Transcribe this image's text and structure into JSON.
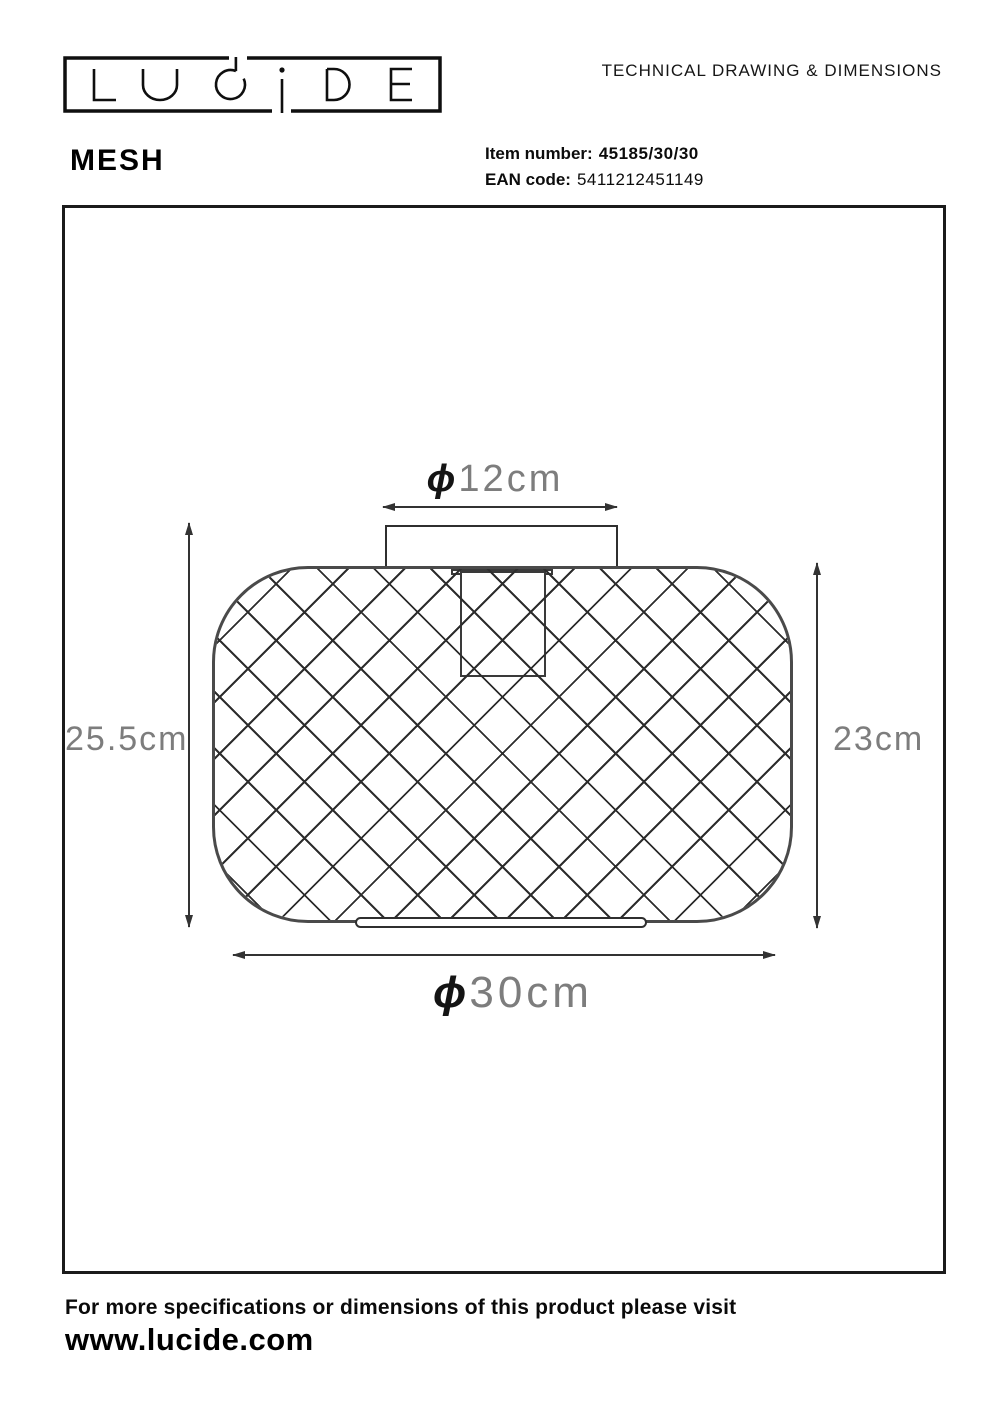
{
  "header": {
    "brand": "LUCIDE",
    "doc_title": "TECHNICAL DRAWING & DIMENSIONS",
    "product_name": "MESH",
    "item_number_label": "Item number:",
    "item_number_value": "45185/30/30",
    "ean_label": "EAN code:",
    "ean_value": "5411212451149"
  },
  "drawing": {
    "dim_top": {
      "prefix": "ϕ",
      "value": "12cm"
    },
    "dim_left": {
      "value": "25.5cm"
    },
    "dim_right": {
      "value": "23cm"
    },
    "dim_bottom": {
      "prefix": "ϕ",
      "value": "30cm"
    }
  },
  "footer": {
    "note": "For more specifications or dimensions of this product please visit",
    "website": "www.lucide.com"
  },
  "colors": {
    "ink": "#111111",
    "dimension_line": "#333333",
    "mesh_line": "#2d2d2d",
    "body_outline": "#4a4a4a",
    "dim_text": "#7d7d7d"
  }
}
